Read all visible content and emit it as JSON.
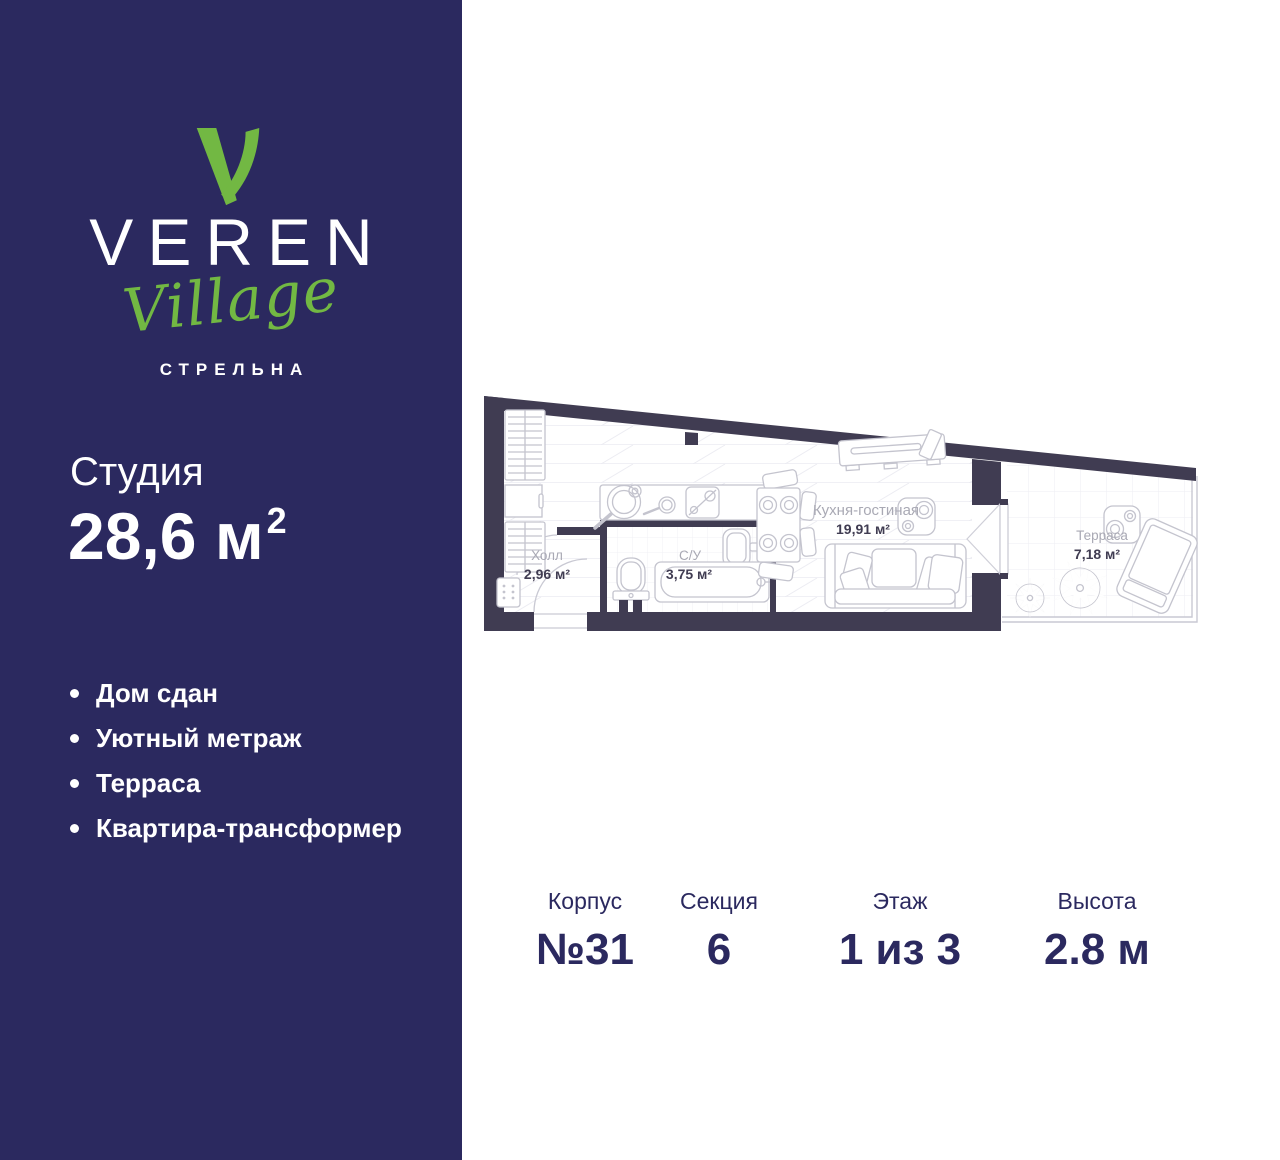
{
  "brand": {
    "name": "VEREN",
    "sub": "Village",
    "city": "СТРЕЛЬНА"
  },
  "listing": {
    "type": "Студия",
    "area_value": "28,6",
    "area_unit": "м",
    "area_sup": "2"
  },
  "features": [
    "Дом сдан",
    "Уютный метраж",
    "Терраса",
    "Квартира-трансформер"
  ],
  "plan": {
    "rooms": [
      {
        "name": "Холл",
        "area": "2,96 м²"
      },
      {
        "name": "С/У",
        "area": "3,75 м²"
      },
      {
        "name": "Кухня-гостиная",
        "area": "19,91 м²"
      },
      {
        "name": "Терраса",
        "area": "7,18 м²"
      }
    ]
  },
  "specs": [
    {
      "label": "Корпус",
      "value": "№31"
    },
    {
      "label": "Секция",
      "value": "6"
    },
    {
      "label": "Этаж",
      "value": "1 из 3"
    },
    {
      "label": "Высота",
      "value": "2.8 м"
    }
  ],
  "colors": {
    "sidebar": "#2B295F",
    "accent_green": "#72B843",
    "wall": "#403C52",
    "text_navy": "#2B295F",
    "room_label_gray": "#A9A9B4"
  }
}
